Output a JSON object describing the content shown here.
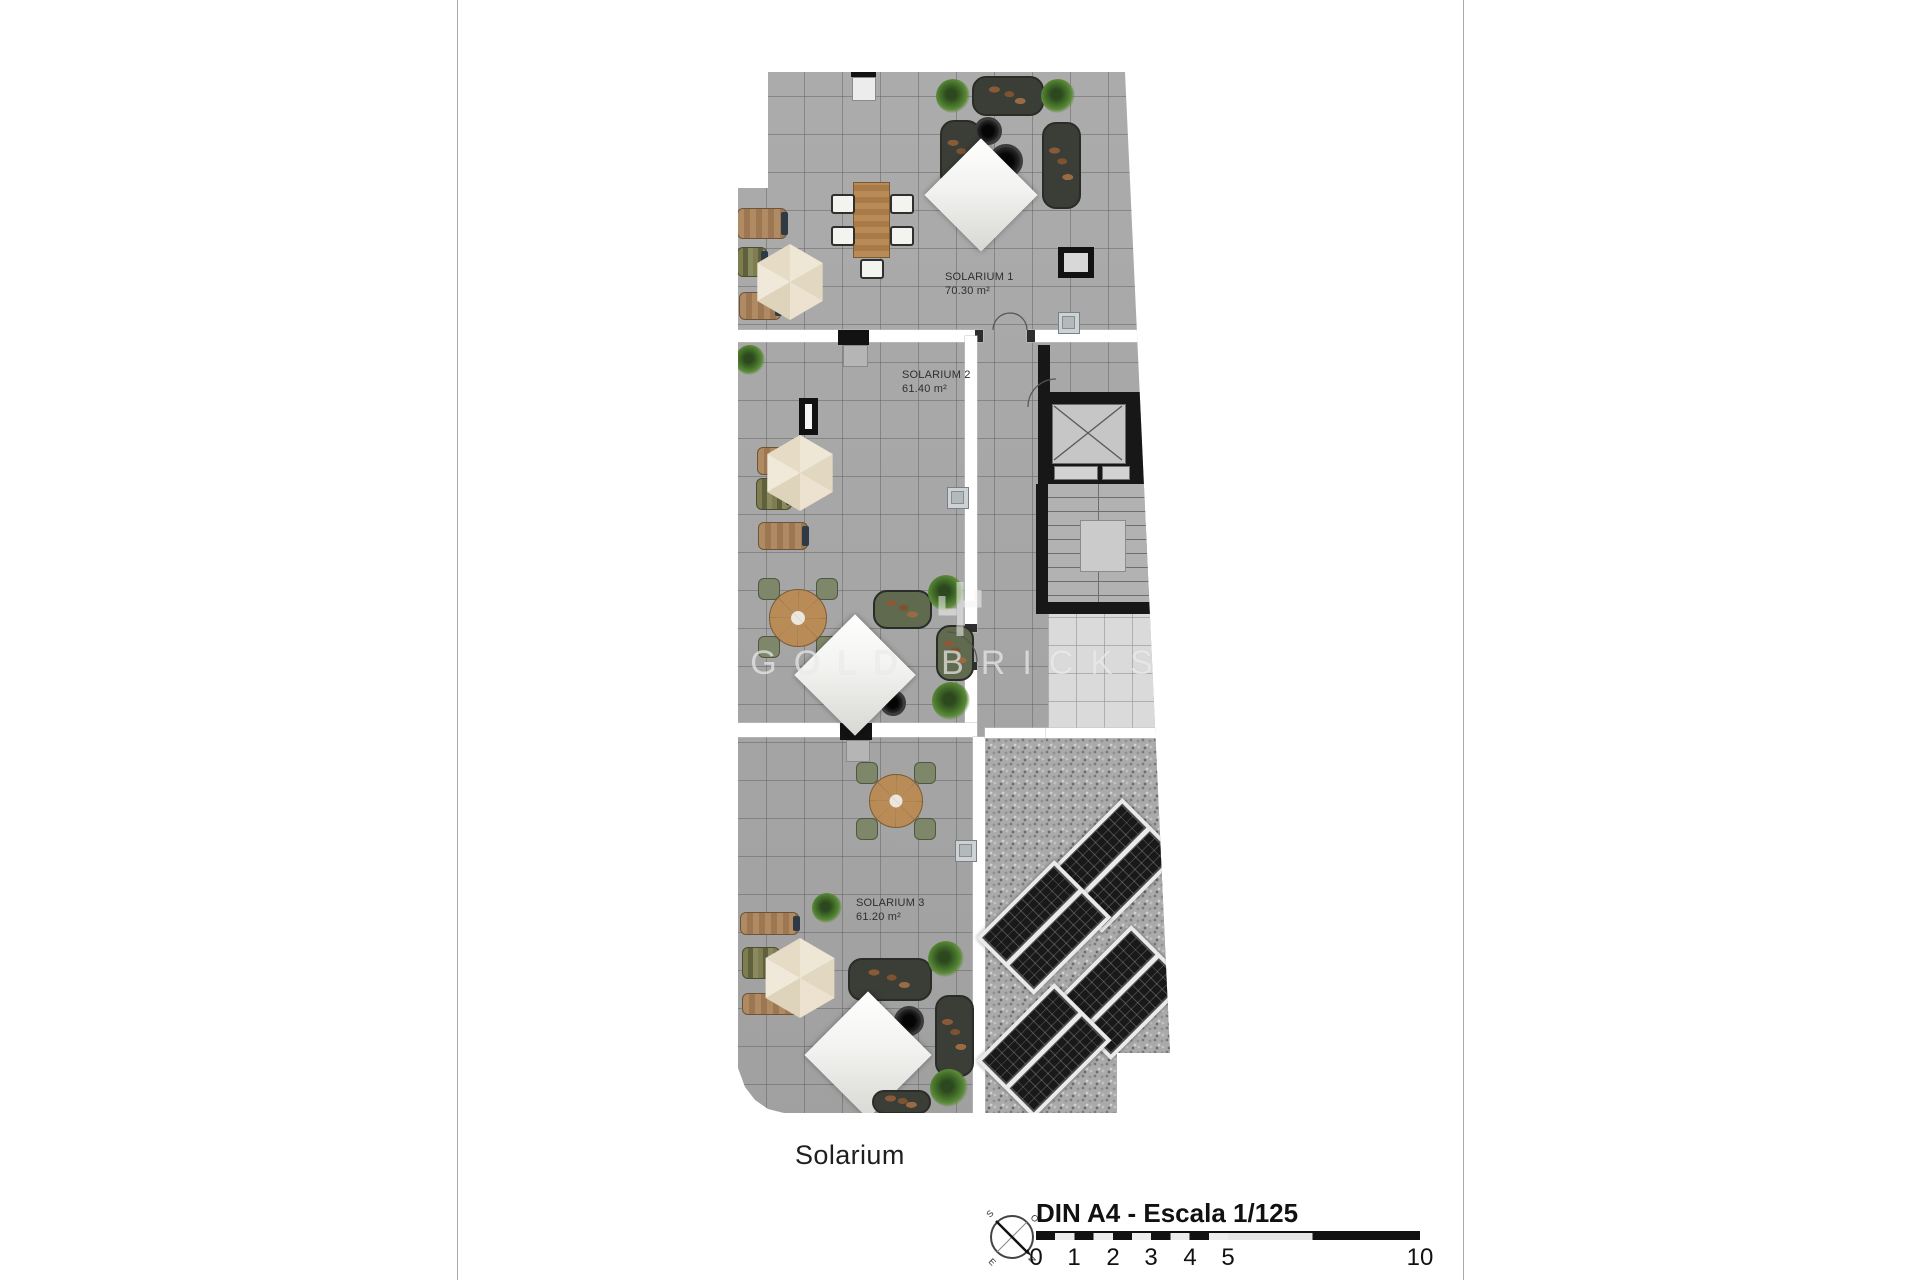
{
  "plan": {
    "caption": "Solarium",
    "rooms": [
      {
        "name": "SOLARIUM 1",
        "area": "70.30 m²"
      },
      {
        "name": "SOLARIUM 2",
        "area": "61.40 m²"
      },
      {
        "name": "SOLARIUM 3",
        "area": "61.20 m²"
      }
    ]
  },
  "watermark": {
    "text": "GOLD BRICKS"
  },
  "compass": {
    "north": "N",
    "south": "S",
    "east": "E",
    "west": "O"
  },
  "footer": {
    "scale_label": "DIN A4 - Escala 1/125",
    "ticks": [
      "0",
      "1",
      "2",
      "3",
      "4",
      "5",
      "10"
    ]
  },
  "colors": {
    "paper": "#ffffff",
    "tile": "#a7a7a7",
    "gravel": "#aaaaaa",
    "wall_black": "#171717",
    "umbrella": "#e8dfca",
    "parasol": "#f4f4f2",
    "sofa": "#3b3e37",
    "wood": "#a97e4f",
    "plant": "#44702a",
    "solar_panel": "#191919",
    "watermark": "rgba(252,252,252,0.62)"
  }
}
